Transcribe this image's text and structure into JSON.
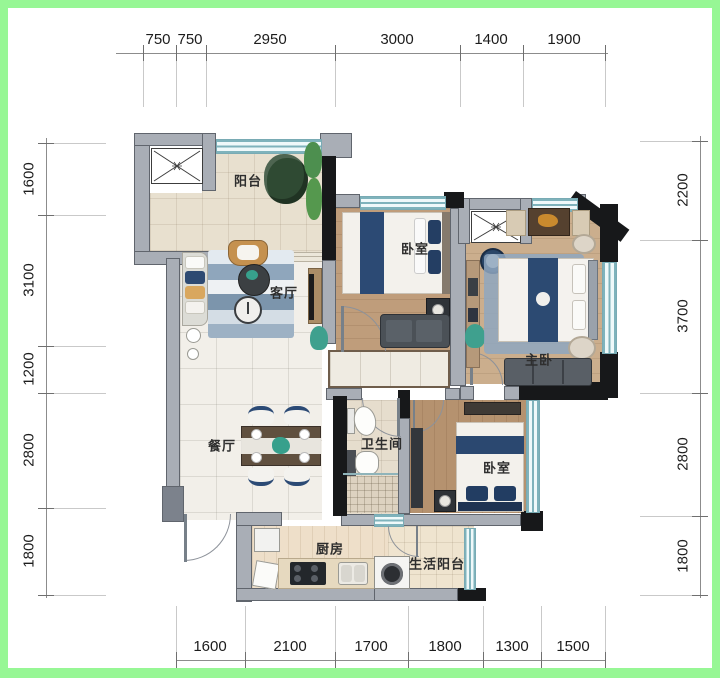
{
  "rooms": [
    {
      "id": "balcony",
      "label": "阳台",
      "x": 240,
      "y": 172
    },
    {
      "id": "living",
      "label": "客厅",
      "x": 276,
      "y": 284
    },
    {
      "id": "bedroom1",
      "label": "卧室",
      "x": 407,
      "y": 240
    },
    {
      "id": "master",
      "label": "主卧",
      "x": 531,
      "y": 351
    },
    {
      "id": "dining",
      "label": "餐厅",
      "x": 214,
      "y": 437
    },
    {
      "id": "bathroom",
      "label": "卫生间",
      "x": 374,
      "y": 435
    },
    {
      "id": "bedroom2",
      "label": "卧室",
      "x": 489,
      "y": 459
    },
    {
      "id": "kitchen",
      "label": "厨房",
      "x": 322,
      "y": 540
    },
    {
      "id": "utility",
      "label": "生活阳台",
      "x": 429,
      "y": 555
    }
  ],
  "dimensions": {
    "top": {
      "pos": 45,
      "from": 108,
      "to": 600,
      "ticks": [
        135,
        168,
        198,
        327,
        452,
        515,
        597
      ],
      "labels": [
        {
          "text": "750",
          "c": 150
        },
        {
          "text": "750",
          "c": 182
        },
        {
          "text": "2950",
          "c": 262
        },
        {
          "text": "3000",
          "c": 389
        },
        {
          "text": "1400",
          "c": 483
        },
        {
          "text": "1900",
          "c": 556
        }
      ]
    },
    "bottom": {
      "pos": 652,
      "from": 168,
      "to": 597,
      "ticks": [
        168,
        237,
        327,
        400,
        475,
        533,
        597
      ],
      "labels": [
        {
          "text": "1600",
          "c": 202
        },
        {
          "text": "2100",
          "c": 282
        },
        {
          "text": "1700",
          "c": 363
        },
        {
          "text": "1800",
          "c": 437
        },
        {
          "text": "1300",
          "c": 504
        },
        {
          "text": "1500",
          "c": 565
        }
      ]
    },
    "left": {
      "pos": 38,
      "from": 130,
      "to": 590,
      "ticks": [
        135,
        207,
        338,
        385,
        500,
        587
      ],
      "labels": [
        {
          "text": "1600",
          "c": 171
        },
        {
          "text": "3100",
          "c": 272
        },
        {
          "text": "1200",
          "c": 361
        },
        {
          "text": "2800",
          "c": 442
        },
        {
          "text": "1800",
          "c": 543
        }
      ]
    },
    "right": {
      "pos": 692,
      "from": 128,
      "to": 590,
      "ticks": [
        133,
        232,
        385,
        508,
        587
      ],
      "labels": [
        {
          "text": "2200",
          "c": 182
        },
        {
          "text": "3700",
          "c": 308
        },
        {
          "text": "2800",
          "c": 446
        },
        {
          "text": "1800",
          "c": 548
        }
      ]
    }
  },
  "colors": {
    "frame_green": "#97f795",
    "wall_gray": "#a9aeb6",
    "wall_black": "#17181a",
    "window_teal": "#cfe9ec",
    "wood": "#bf9d7b",
    "navy": "#2c4a74",
    "plant_teal": "#37a08c"
  }
}
